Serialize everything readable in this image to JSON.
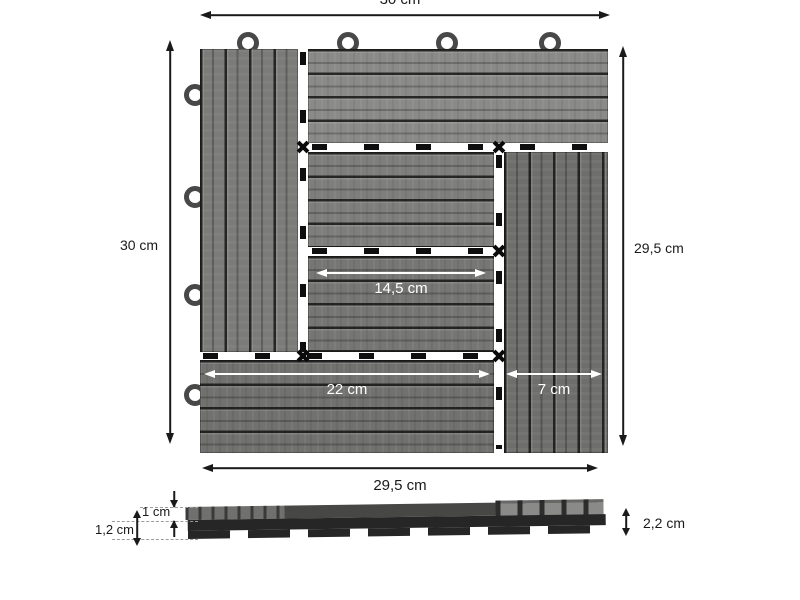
{
  "diagram": {
    "top_view": {
      "width_total": "30 cm",
      "height_total": "30 cm",
      "height_tile": "29,5 cm",
      "width_tile": "29,5 cm",
      "center_width": "14,5 cm",
      "bottom_board_width": "22 cm",
      "right_board_width": "7 cm"
    },
    "side_view": {
      "board_thickness": "1 cm",
      "base_height": "1,2 cm",
      "total_height": "2,2 cm"
    },
    "colors": {
      "plank_gray": "#7d7d7b",
      "groove_dark": "#3a3a3a",
      "connector_black": "#0f0f0f",
      "base_black": "#262626",
      "dimension_line": "#1a1a1a",
      "inner_dimension_white": "#ffffff"
    }
  }
}
